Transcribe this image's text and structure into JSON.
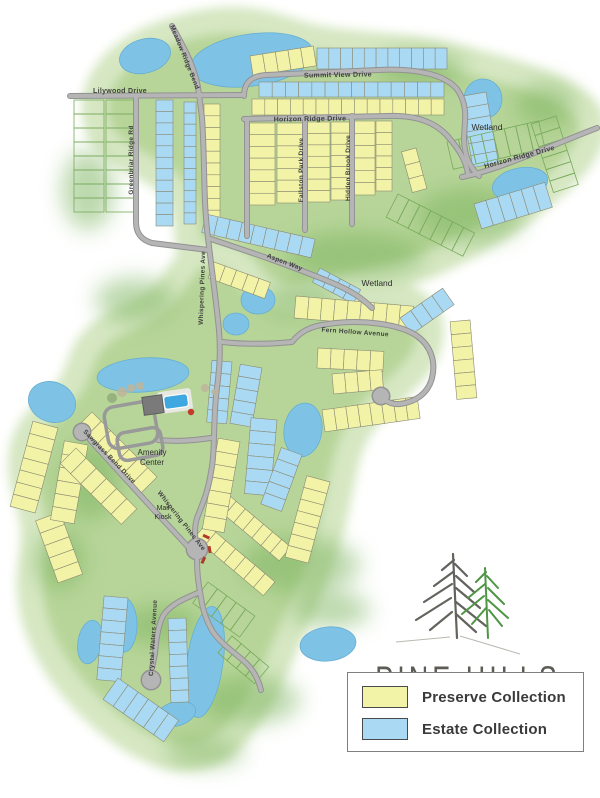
{
  "community": {
    "name": "PINE HILLS"
  },
  "legend": {
    "items": [
      {
        "label": "Preserve Collection",
        "key": "preserve"
      },
      {
        "label": "Estate Collection",
        "key": "estate"
      }
    ]
  },
  "colors": {
    "preserve": "#f2f3a6",
    "estate": "#aadaf3",
    "lot_stroke": "#8b8b74",
    "ghost_stroke": "#79aa5d",
    "water": "#7ec3e5",
    "water_stroke": "#66aed3",
    "road": "#b5b5b5",
    "road_casing": "#929292",
    "green": "#b7d599",
    "green_halo": "#d6e7c2",
    "green_dark": "#79b25b",
    "street_label": "#3f3f3f",
    "area_label": "#2d2d2d",
    "logo_text": "#5c5b55",
    "tree_gray": "#63635e",
    "tree_green": "#4e9544",
    "kiosk_red": "#b03a2a"
  },
  "map": {
    "area_labels": [
      {
        "t": "Wetland",
        "x": 487,
        "y": 130,
        "s": 8.5
      },
      {
        "t": "Wetland",
        "x": 377,
        "y": 286,
        "s": 8.5
      },
      {
        "t": "Amenity",
        "x": 152,
        "y": 455,
        "s": 8
      },
      {
        "t": "Center",
        "x": 152,
        "y": 465,
        "s": 8
      },
      {
        "t": "Mail",
        "x": 163,
        "y": 510,
        "s": 7
      },
      {
        "t": "Kiosk",
        "x": 163,
        "y": 519,
        "s": 7
      }
    ],
    "street_labels": [
      {
        "t": "Summit View Drive",
        "x": 338,
        "y": 77,
        "s": 7,
        "a": -1
      },
      {
        "t": "Lilywood Drive",
        "x": 120,
        "y": 93,
        "s": 7,
        "a": 0
      },
      {
        "t": "Horizon Ridge Drive",
        "x": 310,
        "y": 121,
        "s": 7,
        "a": -1
      },
      {
        "t": "Horizon Ridge Drive",
        "x": 520,
        "y": 159,
        "s": 7,
        "a": -15
      },
      {
        "t": "Greenbriar Ridge Rd",
        "x": 133,
        "y": 160,
        "s": 6.5,
        "a": -90
      },
      {
        "t": "Meadow Ridge Bend",
        "x": 183,
        "y": 58,
        "s": 6.5,
        "a": 68
      },
      {
        "t": "Whispering Pines Ave",
        "x": 204,
        "y": 288,
        "s": 6.5,
        "a": -88
      },
      {
        "t": "Whispering Pines Ave",
        "x": 180,
        "y": 522,
        "s": 6.5,
        "a": 52
      },
      {
        "t": "Fallston Park Drive",
        "x": 303,
        "y": 170,
        "s": 6.5,
        "a": -90
      },
      {
        "t": "Hidden Brook Drive",
        "x": 350,
        "y": 168,
        "s": 6.5,
        "a": -90
      },
      {
        "t": "Fern Hollow Avenue",
        "x": 355,
        "y": 334,
        "s": 6.5,
        "a": 4
      },
      {
        "t": "Aspen Way",
        "x": 284,
        "y": 264,
        "s": 6.5,
        "a": 21
      },
      {
        "t": "Sawgrass Bend Drive",
        "x": 108,
        "y": 458,
        "s": 6.5,
        "a": 46
      },
      {
        "t": "Crystal Waters Avenue",
        "x": 155,
        "y": 638,
        "s": 6.5,
        "a": -87
      }
    ],
    "lot_strips": [
      {
        "x": 250,
        "y": 56,
        "len": 64,
        "d": 20,
        "a": -9,
        "n": 5,
        "c": "p"
      },
      {
        "x": 317,
        "y": 48,
        "len": 130,
        "d": 21,
        "a": 0,
        "n": 11,
        "c": "e"
      },
      {
        "x": 259,
        "y": 82,
        "len": 185,
        "d": 15,
        "a": 0,
        "n": 14,
        "c": "e"
      },
      {
        "x": 252,
        "y": 99,
        "len": 192,
        "d": 16,
        "a": 0,
        "n": 15,
        "c": "p"
      },
      {
        "x": 275,
        "y": 123,
        "len": 82,
        "d": 26,
        "a": 90,
        "n": 7,
        "c": "p"
      },
      {
        "x": 303,
        "y": 123,
        "len": 80,
        "d": 26,
        "a": 90,
        "n": 7,
        "c": "p"
      },
      {
        "x": 330,
        "y": 122,
        "len": 80,
        "d": 24,
        "a": 90,
        "n": 7,
        "c": "p"
      },
      {
        "x": 350,
        "y": 122,
        "len": 78,
        "d": 19,
        "a": 90,
        "n": 7,
        "c": "p"
      },
      {
        "x": 375,
        "y": 121,
        "len": 74,
        "d": 22,
        "a": 90,
        "n": 6,
        "c": "p"
      },
      {
        "x": 392,
        "y": 121,
        "len": 70,
        "d": 16,
        "a": 90,
        "n": 6,
        "c": "p"
      },
      {
        "x": 173,
        "y": 100,
        "len": 126,
        "d": 17,
        "a": 90,
        "n": 11,
        "c": "e"
      },
      {
        "x": 196,
        "y": 102,
        "len": 122,
        "d": 12,
        "a": 90,
        "n": 11,
        "c": "e"
      },
      {
        "x": 220,
        "y": 104,
        "len": 118,
        "d": 16,
        "a": 90,
        "n": 10,
        "c": "p"
      },
      {
        "x": 486,
        "y": 92,
        "len": 72,
        "d": 26,
        "a": 80,
        "n": 6,
        "c": "e"
      },
      {
        "x": 474,
        "y": 204,
        "len": 74,
        "d": 26,
        "a": -17,
        "n": 6,
        "c": "e"
      },
      {
        "x": 206,
        "y": 214,
        "len": 112,
        "d": 19,
        "a": 13,
        "n": 9,
        "c": "e"
      },
      {
        "x": 214,
        "y": 262,
        "len": 60,
        "d": 17,
        "a": 20,
        "n": 5,
        "c": "p"
      },
      {
        "x": 320,
        "y": 268,
        "len": 46,
        "d": 16,
        "a": 28,
        "n": 4,
        "c": "e"
      },
      {
        "x": 416,
        "y": 148,
        "len": 42,
        "d": 15,
        "a": 75,
        "n": 3,
        "c": "p"
      },
      {
        "x": 296,
        "y": 296,
        "len": 118,
        "d": 22,
        "a": 5,
        "n": 9,
        "c": "p"
      },
      {
        "x": 470,
        "y": 320,
        "len": 78,
        "d": 20,
        "a": 85,
        "n": 6,
        "c": "p"
      },
      {
        "x": 322,
        "y": 410,
        "len": 96,
        "d": 22,
        "a": -8,
        "n": 8,
        "c": "p"
      },
      {
        "x": 318,
        "y": 348,
        "len": 66,
        "d": 20,
        "a": 3,
        "n": 5,
        "c": "p"
      },
      {
        "x": 332,
        "y": 374,
        "len": 50,
        "d": 20,
        "a": -5,
        "n": 4,
        "c": "p"
      },
      {
        "x": 400,
        "y": 318,
        "len": 52,
        "d": 20,
        "a": -35,
        "n": 4,
        "c": "e"
      },
      {
        "x": 232,
        "y": 362,
        "len": 62,
        "d": 20,
        "a": 95,
        "n": 5,
        "c": "e"
      },
      {
        "x": 262,
        "y": 368,
        "len": 60,
        "d": 22,
        "a": 100,
        "n": 5,
        "c": "e"
      },
      {
        "x": 277,
        "y": 420,
        "len": 76,
        "d": 26,
        "a": 95,
        "n": 6,
        "c": "e"
      },
      {
        "x": 302,
        "y": 455,
        "len": 60,
        "d": 22,
        "a": 110,
        "n": 5,
        "c": "e"
      },
      {
        "x": 58,
        "y": 428,
        "len": 88,
        "d": 26,
        "a": 105,
        "n": 7,
        "c": "p"
      },
      {
        "x": 60,
        "y": 512,
        "len": 66,
        "d": 26,
        "a": 70,
        "n": 5,
        "c": "p"
      },
      {
        "x": 88,
        "y": 445,
        "len": 80,
        "d": 24,
        "a": 100,
        "n": 6,
        "c": "p"
      },
      {
        "x": 92,
        "y": 412,
        "len": 92,
        "d": 22,
        "a": 45,
        "n": 7,
        "c": "p"
      },
      {
        "x": 76,
        "y": 448,
        "len": 86,
        "d": 22,
        "a": 45,
        "n": 6,
        "c": "p"
      },
      {
        "x": 218,
        "y": 486,
        "len": 95,
        "d": 18,
        "a": 40,
        "n": 8,
        "c": "p"
      },
      {
        "x": 206,
        "y": 524,
        "len": 90,
        "d": 18,
        "a": 40,
        "n": 7,
        "c": "p"
      },
      {
        "x": 240,
        "y": 442,
        "len": 92,
        "d": 22,
        "a": 100,
        "n": 7,
        "c": "p"
      },
      {
        "x": 330,
        "y": 482,
        "len": 84,
        "d": 24,
        "a": 105,
        "n": 7,
        "c": "p"
      },
      {
        "x": 128,
        "y": 598,
        "len": 84,
        "d": 24,
        "a": 95,
        "n": 7,
        "c": "e"
      },
      {
        "x": 118,
        "y": 678,
        "len": 74,
        "d": 26,
        "a": 35,
        "n": 6,
        "c": "e"
      },
      {
        "x": 186,
        "y": 618,
        "len": 84,
        "d": 18,
        "a": 88,
        "n": 7,
        "c": "e"
      },
      {
        "x": 104,
        "y": 100,
        "len": 112,
        "d": 30,
        "a": 90,
        "n": 8,
        "c": "g"
      },
      {
        "x": 134,
        "y": 100,
        "len": 112,
        "d": 28,
        "a": 90,
        "n": 8,
        "c": "g"
      },
      {
        "x": 447,
        "y": 142,
        "len": 94,
        "d": 28,
        "a": -13,
        "n": 8,
        "c": "g"
      },
      {
        "x": 556,
        "y": 116,
        "len": 72,
        "d": 26,
        "a": 72,
        "n": 6,
        "c": "g"
      },
      {
        "x": 398,
        "y": 194,
        "len": 86,
        "d": 26,
        "a": 27,
        "n": 7,
        "c": "g"
      },
      {
        "x": 208,
        "y": 582,
        "len": 58,
        "d": 26,
        "a": 36,
        "n": 5,
        "c": "g"
      },
      {
        "x": 232,
        "y": 636,
        "len": 48,
        "d": 22,
        "a": 40,
        "n": 4,
        "c": "g"
      }
    ]
  }
}
